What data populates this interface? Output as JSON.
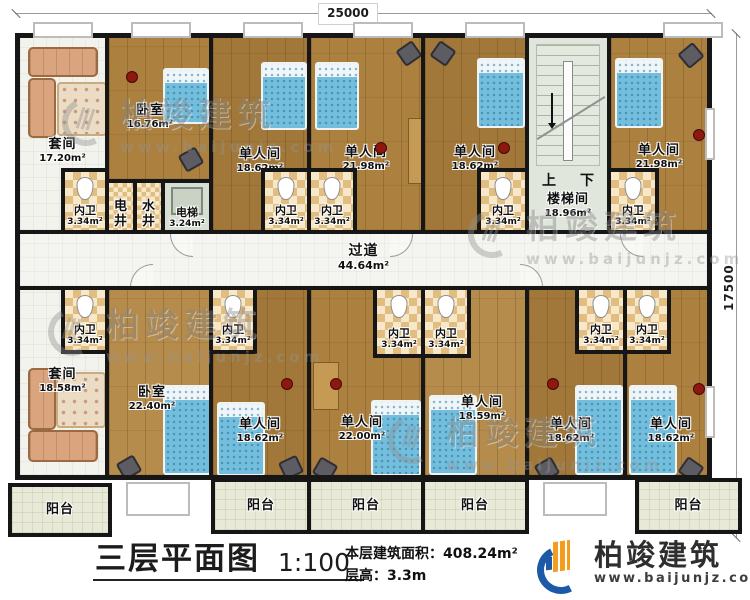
{
  "dimensions": {
    "width": "25000",
    "height": "17500"
  },
  "title_block": {
    "title": "三层平面图",
    "scale": "1:100",
    "area_line": "本层建筑面积：408.24m²",
    "height_line": "层高：3.3m"
  },
  "brand": {
    "name": "柏竣建筑",
    "website": "www.baijunjz.com",
    "blue": "#1c59a6",
    "orange": "#f39c1e"
  },
  "watermark": {
    "name": "柏竣建筑",
    "website": "www.baijunjz.com"
  },
  "stairs": {
    "up": "上",
    "down": "下"
  },
  "rooms": {
    "suite_top": {
      "name": "套间",
      "area": "17.20m²"
    },
    "bedroom_top": {
      "name": "卧室",
      "area": "16.76m²"
    },
    "bath_suite_top": {
      "name": "内卫",
      "area": "3.34m²"
    },
    "shaft_elec": {
      "name": "电井"
    },
    "shaft_water": {
      "name": "水井"
    },
    "elevator": {
      "name": "电梯",
      "area": "3.24m²"
    },
    "single_top_1": {
      "name": "单人间",
      "area": "18.62m²"
    },
    "bath_top_1": {
      "name": "内卫",
      "area": "3.34m²"
    },
    "bath_top_2": {
      "name": "内卫",
      "area": "3.34m²"
    },
    "single_top_2": {
      "name": "单人间",
      "area": "21.98m²"
    },
    "single_top_3": {
      "name": "单人间",
      "area": "18.62m²"
    },
    "bath_top_3": {
      "name": "内卫",
      "area": "3.34m²"
    },
    "stairwell": {
      "name": "楼梯间",
      "area": "18.96m²"
    },
    "bath_top_4": {
      "name": "内卫",
      "area": "3.34m²"
    },
    "single_top_4": {
      "name": "单人间",
      "area": "21.98m²"
    },
    "corridor": {
      "name": "过道",
      "area": "44.64m²"
    },
    "bath_bot_suite": {
      "name": "内卫",
      "area": "3.34m²"
    },
    "suite_bottom": {
      "name": "套间",
      "area": "18.58m²"
    },
    "bedroom_bottom": {
      "name": "卧室",
      "area": "22.40m²"
    },
    "bath_bot_1": {
      "name": "内卫",
      "area": "3.34m²"
    },
    "single_bot_1": {
      "name": "单人间",
      "area": "18.62m²"
    },
    "single_bot_2": {
      "name": "单人间",
      "area": "22.00m²"
    },
    "bath_bot_2": {
      "name": "内卫",
      "area": "3.34m²"
    },
    "bath_bot_3": {
      "name": "内卫",
      "area": "3.34m²"
    },
    "single_bot_3": {
      "name": "单人间",
      "area": "18.59m²"
    },
    "bath_bot_4": {
      "name": "内卫",
      "area": "3.34m²"
    },
    "bath_bot_5": {
      "name": "内卫",
      "area": "3.34m²"
    },
    "single_bot_4": {
      "name": "单人间",
      "area": "18.62m²"
    },
    "single_bot_5": {
      "name": "单人间",
      "area": "18.62m²"
    }
  },
  "balconies": [
    "阳台",
    "阳台",
    "阳台",
    "阳台",
    "阳台"
  ]
}
